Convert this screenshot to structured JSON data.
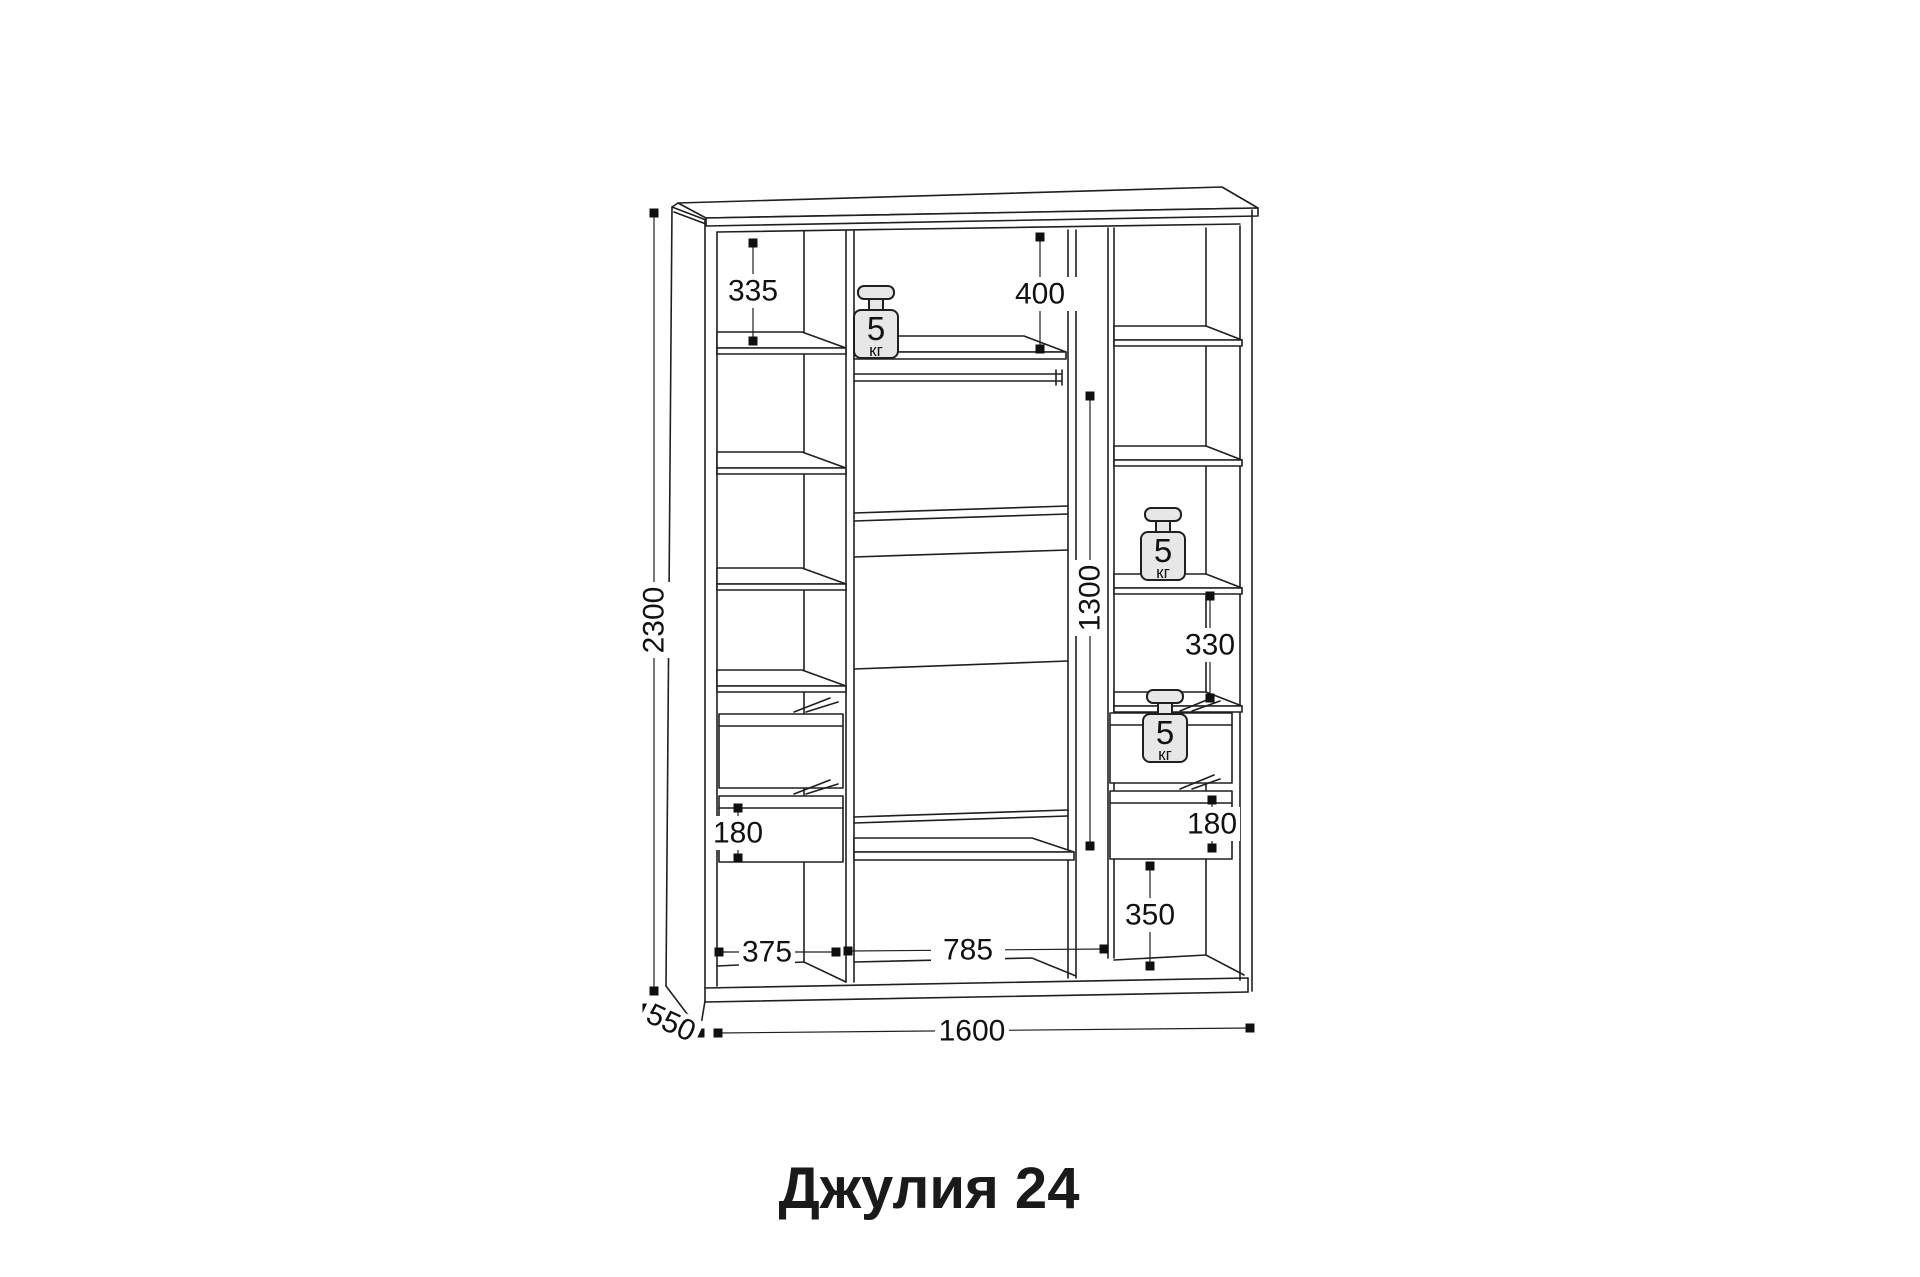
{
  "title": "Джулия 24",
  "weight_badge": {
    "value": "5",
    "unit": "кг"
  },
  "dimensions": {
    "overall_height": "2300",
    "overall_width": "1600",
    "depth": "550",
    "left_top_shelf_height": "335",
    "center_top_section_height": "400",
    "hanging_space_height": "1300",
    "right_shelf_spacing": "330",
    "left_drawer_height": "180",
    "right_drawer_height": "180",
    "right_bottom_section_height": "350",
    "left_section_width": "375",
    "center_section_width": "785"
  },
  "colors": {
    "line": "#1f1f1f",
    "marker": "#0f0f0f",
    "weight_fill": "#e7e7e7",
    "text": "#111111"
  }
}
